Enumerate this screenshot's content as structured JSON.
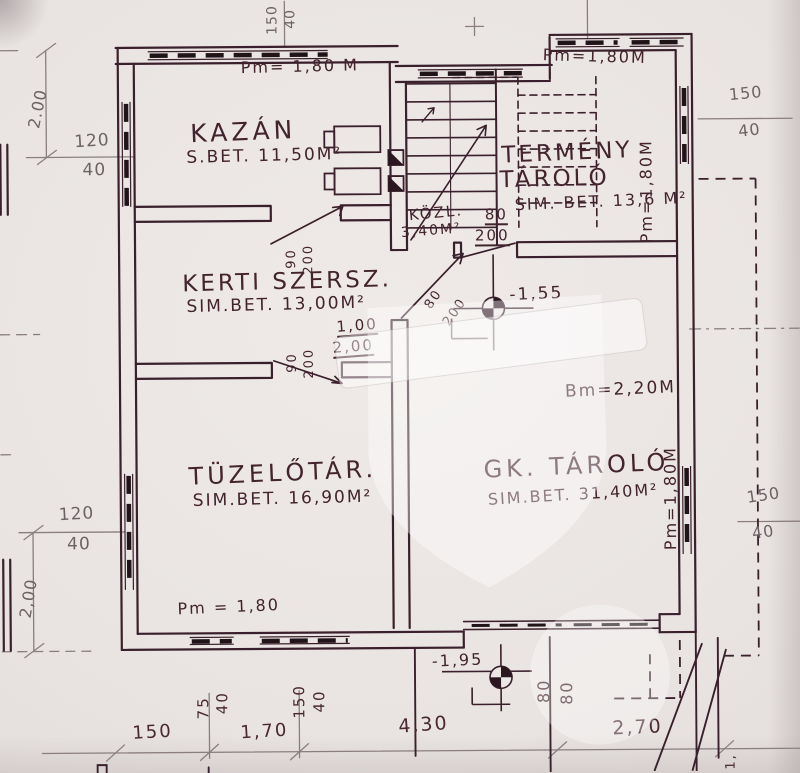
{
  "rooms": {
    "kazan": {
      "name": "KAZÁN",
      "spec": "S.BET. 11,50M²"
    },
    "kerti_szersz": {
      "name": "KERTI SZERSZ.",
      "spec": "SIM.BET. 13,00M²"
    },
    "tuzelotar": {
      "name": "TÜZELŐTÁR.",
      "spec": "SIM.BET. 16,90M²"
    },
    "gk_tarolo": {
      "name": "GK. TÁROLÓ",
      "spec": "SIM.BET. 31,40M²"
    },
    "termeny_tarolo": {
      "name_line1": "TERMÉNY",
      "name_line2": "TÁROLÓ",
      "spec": "SIM. BET. 13,6 M²"
    },
    "kozl": {
      "name": "KÖZL.",
      "spec": "3,40M²"
    }
  },
  "heights": {
    "pm_top_left": "Pm= 1,80 M",
    "pm_top_right": "Pm=1,80M",
    "pm_right_upper": "Pm=1,80M",
    "pm_right_lower": "Pm=1,80M",
    "pm_bottom": "Pm = 1,80",
    "bm_right": "Bm=2,20M"
  },
  "levels": {
    "mid": "-1,55",
    "lower": "-1,95"
  },
  "doors": {
    "stair_fraction": {
      "w": "80",
      "h": "200"
    },
    "mid_door": {
      "w": "1,00",
      "h": "2,00"
    },
    "door_upper": {
      "w": "90",
      "h": "200"
    },
    "door_lower": {
      "w": "90",
      "h": "200"
    },
    "garage_pair": {
      "a": "80",
      "b": "80"
    }
  },
  "dimensions": {
    "left_upper": {
      "length": "2.00",
      "win_w": "120",
      "sill": "40"
    },
    "left_lower": {
      "length": "2,00",
      "win_w": "120",
      "sill": "40"
    },
    "right_upper": {
      "win_w": "150",
      "sill": "40"
    },
    "right_lower": {
      "win_w": "150",
      "sill": "40"
    },
    "top_edge": {
      "win_w": "150",
      "sill": "40"
    },
    "bottom_small": {
      "win_w": "75",
      "sill": "40"
    },
    "bottom_large": {
      "win_w": "150",
      "sill": "40"
    },
    "bottom_row": {
      "d1": "150",
      "d2": "1,70",
      "d3": "4,30",
      "d4": "2,70"
    },
    "corner_note": "1,"
  }
}
